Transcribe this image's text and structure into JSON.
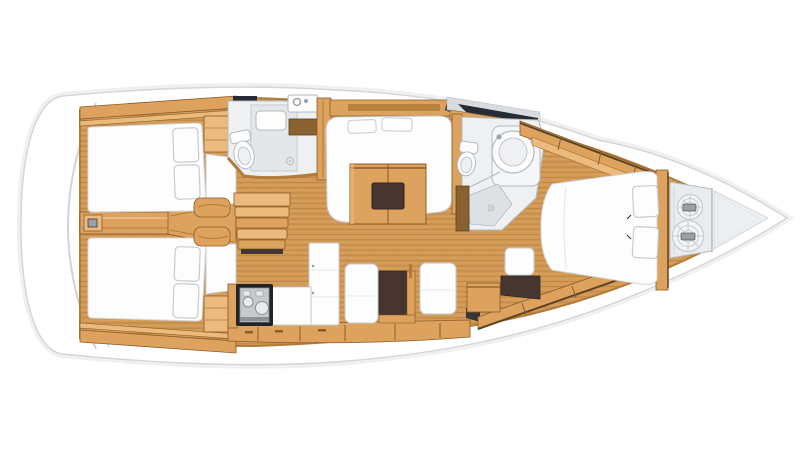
{
  "meta": {
    "title": "Sailing yacht interior layout — top-down floor plan, bow to the right",
    "view": "overhead",
    "orientation": {
      "bow": "right",
      "stern": "left"
    }
  },
  "palette": {
    "bg": "#ffffff",
    "hullFill": "#ffffff",
    "hullStroke": "#d2d6d9",
    "hullHalo": "#eef0f2",
    "deckLine": "#cfd4d7",
    "deckLine2": "#e4e7e9",
    "woodFloor": "#d39a56",
    "plankLine": "#ba8544",
    "plankLight": "#e8b872",
    "woodMid": "#dda25e",
    "woodLight": "#ecba7c",
    "woodDark": "#b07c38",
    "woodDeep": "#8a5c26",
    "woodBrown": "#8a6130",
    "shadowBrown": "#5e4420",
    "white": "#fdfdfe",
    "cushionStroke": "#c6cbcf",
    "seamGray": "#e2e6e8",
    "bathWall": "#eef0f1",
    "bathFloor": "#dde1e4",
    "bathLine": "#b3bac0",
    "offWhite": "#f4f6f7",
    "grayDeck": "#d8dcdf",
    "lockerGray": "#e9ebed",
    "darkWedge": "#272b33",
    "darkBrown": "#463530",
    "darkEdge": "#2f2420",
    "stoveBlack": "#222326",
    "stoveGray": "#c7cacc",
    "stoveLine": "#8c9195",
    "stoveBurner": "#e8eaeb",
    "metalGray": "#9aa0a6",
    "ropeFill": "#f3f4f5",
    "ropeStroke": "#c6cbcf",
    "bowTri": "#edeff1"
  },
  "vessel": {
    "areas": [
      {
        "id": "transom",
        "label": "Stern swim platform with molded steps"
      },
      {
        "id": "aft-cabin-port",
        "label": "Aft cabin (top)",
        "features": [
          "double berth",
          "2 pillows",
          "wardrobe"
        ]
      },
      {
        "id": "aft-cabin-starboard",
        "label": "Aft cabin (bottom)",
        "features": [
          "double berth",
          "2 pillows",
          "wardrobe"
        ]
      },
      {
        "id": "companionway",
        "label": "Companionway steps",
        "features": [
          "4 treads",
          "side benches"
        ]
      },
      {
        "id": "aft-head",
        "label": "Aft head",
        "features": [
          "toilet",
          "shower stall",
          "sink with faucet",
          "drain"
        ]
      },
      {
        "id": "saloon",
        "label": "Saloon",
        "features": [
          "U-shaped settee",
          "folding table with dark inlay",
          "2 back cushions"
        ]
      },
      {
        "id": "galley",
        "label": "Galley",
        "features": [
          "gas stove",
          "L-shaped counter",
          "tall locker",
          "base drawers"
        ]
      },
      {
        "id": "nav-station",
        "label": "Navigation / dinette",
        "features": [
          "2 facing seats",
          "dark chart desk"
        ]
      },
      {
        "id": "forward-head",
        "label": "Forward head",
        "features": [
          "toilet",
          "round washbasin",
          "shower floor with drain",
          "wood door"
        ]
      },
      {
        "id": "forward-cabin",
        "label": "Forward cabin",
        "features": [
          "island double berth",
          "2 pillows",
          "vanity seat",
          "hull shelving"
        ]
      },
      {
        "id": "anchor-locker",
        "label": "Anchor locker",
        "features": [
          "2 rope coils"
        ]
      },
      {
        "id": "bow",
        "label": "Bow tip"
      }
    ],
    "counts": {
      "cabins": 3,
      "heads": 2,
      "berth_pillows": 6,
      "rope_coils": 2,
      "companionway_treads": 4
    }
  }
}
